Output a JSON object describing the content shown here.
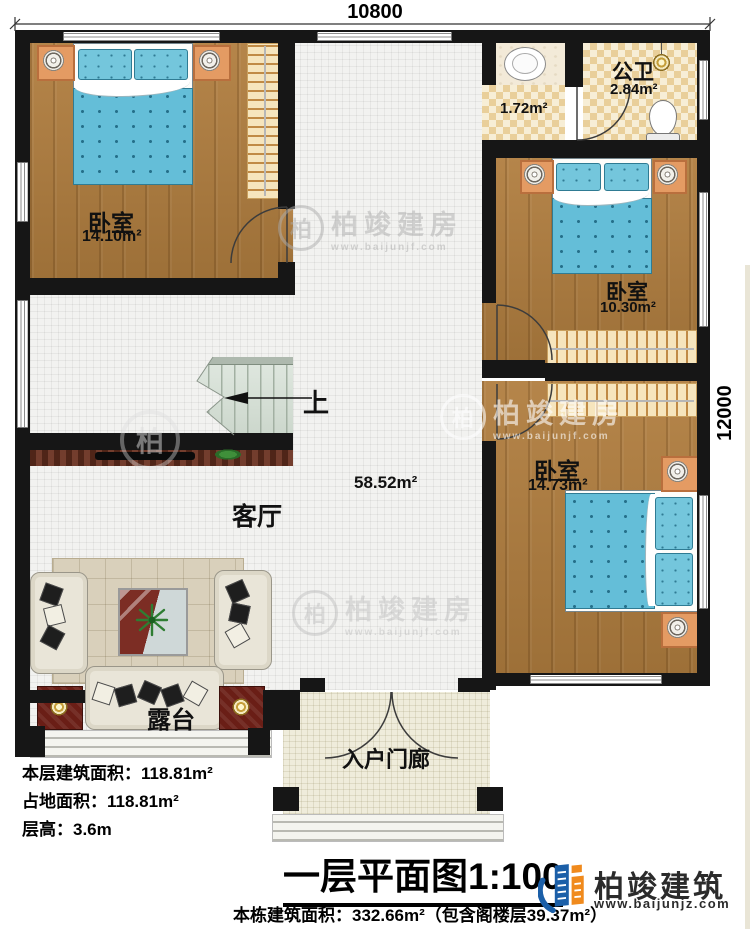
{
  "dimensions": {
    "width_label": "10800",
    "height_label": "12000"
  },
  "rooms": {
    "bedroom_top_left": {
      "label": "卧室",
      "area": "14.10m²"
    },
    "washroom": {
      "area": "1.72m²"
    },
    "bathroom": {
      "label": "公卫",
      "area": "2.84m²"
    },
    "bedroom_mid_right": {
      "label": "卧室",
      "area": "10.30m²"
    },
    "bedroom_bottom_right": {
      "label": "卧室",
      "area": "14.73m²"
    },
    "living_room": {
      "label": "客厅",
      "area": "58.52m²"
    },
    "stairs": {
      "direction_label": "上"
    },
    "terrace": {
      "label": "露台"
    },
    "porch": {
      "label": "入户门廊"
    }
  },
  "info_block": {
    "floor_area": "本层建筑面积：118.81m²",
    "footprint_area": "占地面积：118.81m²",
    "floor_height": "层高：3.6m"
  },
  "title_block": {
    "title": "一层平面图1:100",
    "subtitle": "本栋建筑面积：332.66m²（包含阁楼层39.37m²）"
  },
  "brand": {
    "name": "柏竣建筑",
    "url": "www.baijunjz.com"
  },
  "watermark": {
    "badge": "柏",
    "brand": "柏竣建房",
    "url": "www.baijunjf.com"
  },
  "colors": {
    "wall": "#161616",
    "wood": "#a87c42",
    "bed_blue": "#6ec2da",
    "brand_blue": "#1b5fa8",
    "brand_orange": "#f08a1d"
  }
}
